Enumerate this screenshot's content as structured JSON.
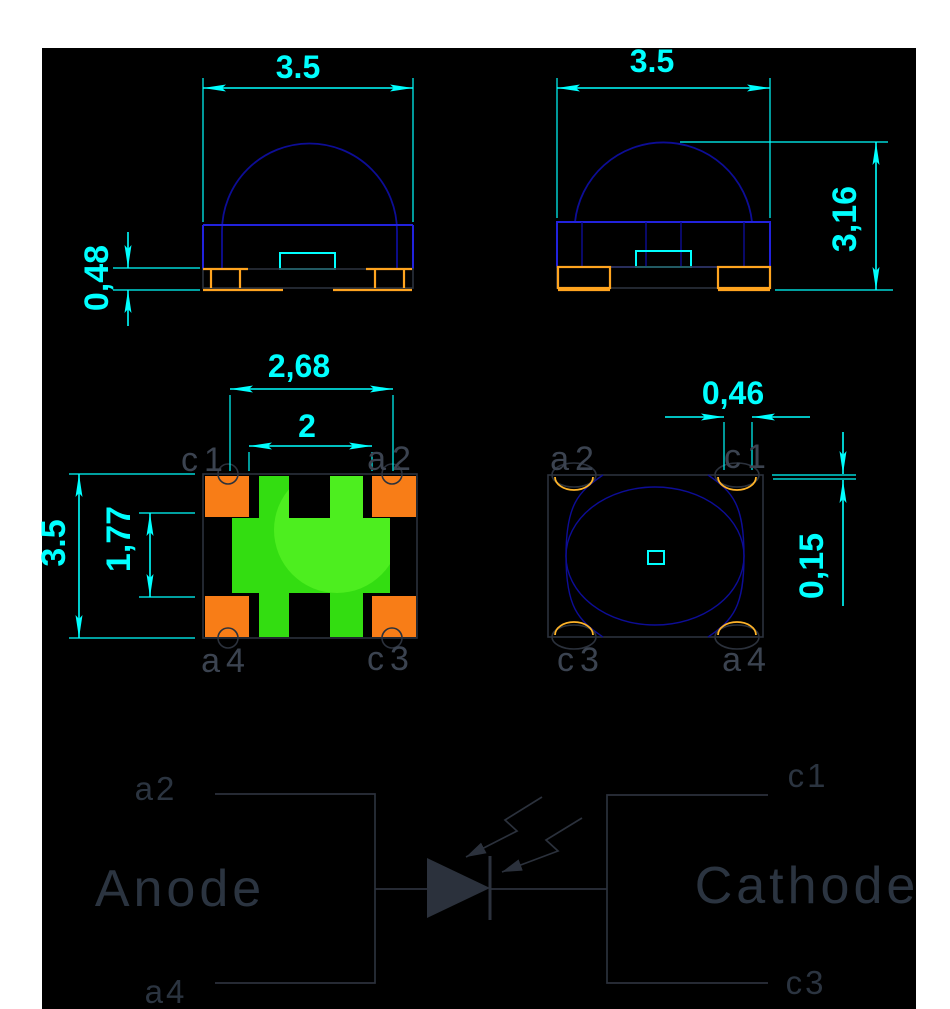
{
  "colors": {
    "page_background": "#ffffff",
    "canvas_background": "#000000",
    "dimension_cyan": "#00ffff",
    "body_outline_blue": "#2222dd",
    "dome_navy": "#0d0d96",
    "pad_orange_fill": "#f87d17",
    "pad_orange_line": "#ffa41f",
    "chip_green": "#33dd11",
    "chip_green_light": "#4dee1f",
    "drawing_gray": "#2b313c",
    "pin_label_gray": "#3b4350"
  },
  "front_view": {
    "width_dim": "3.5",
    "pad_height_dim": "0,48"
  },
  "side_view": {
    "width_dim": "3.5",
    "height_dim": "3,16"
  },
  "bottom_view": {
    "outer_pitch_dim": "2,68",
    "inner_pitch_dim": "2",
    "body_dim": "3.5",
    "center_dim": "1,77",
    "pin_top_left": "c1",
    "pin_top_right": "a2",
    "pin_bottom_left": "a4",
    "pin_bottom_right": "c3"
  },
  "top_view": {
    "notch_dim": "0,46",
    "offset_dim": "0,15",
    "pin_top_left": "a2",
    "pin_top_right": "c1",
    "pin_bottom_left": "c3",
    "pin_bottom_right": "a4"
  },
  "schematic": {
    "anode_label": "Anode",
    "cathode_label": "Cathode",
    "pin_a2": "a2",
    "pin_a4": "a4",
    "pin_c1": "c1",
    "pin_c3": "c3"
  }
}
